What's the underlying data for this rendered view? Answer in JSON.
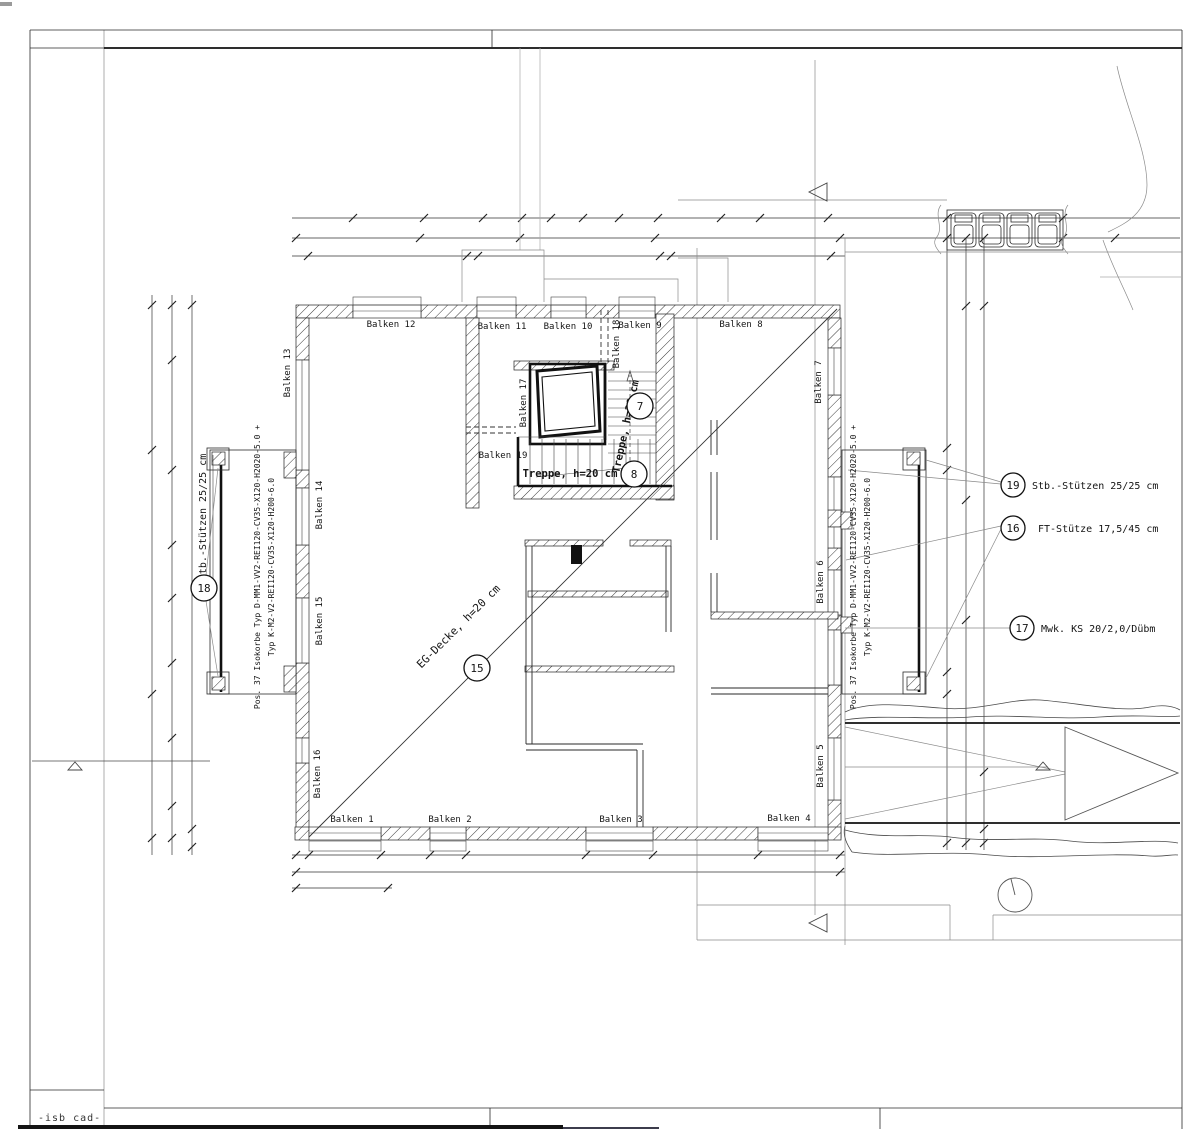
{
  "drawing": {
    "footer": "-isb cad-",
    "beams": [
      "Balken 1",
      "Balken 2",
      "Balken 3",
      "Balken 4",
      "Balken 5",
      "Balken 6",
      "Balken 7",
      "Balken 8",
      "Balken 9",
      "Balken 10",
      "Balken 11",
      "Balken 12",
      "Balken 13",
      "Balken 14",
      "Balken 15",
      "Balken 16",
      "Balken 17",
      "Balken 18",
      "Balken 19"
    ],
    "stairs": {
      "lower": "Treppe, h=20 cm",
      "upper": "Treppe, h=20 cm"
    },
    "deck_label": "EG-Decke, h=20 cm",
    "left_support_label": "Stb.-Stützen 25/25 cm",
    "isokorb": {
      "line1": "Pos. 37 Isokorbe Typ D-MM1-VV2-REI120-CV35-X120-H2020-5.0 +",
      "line2": "Typ K-M2-V2-REI120-CV35-X120-H200-6.0"
    },
    "callouts": {
      "n7": "7",
      "n8": "8",
      "n15": "15",
      "n16": "16",
      "n17": "17",
      "n18": "18",
      "n19": "19"
    },
    "annotations": {
      "a19": "Stb.-Stützen 25/25 cm",
      "a16": "FT-Stütze 17,5/45 cm",
      "a17": "Mwk. KS 20/2,0/Dübm"
    }
  }
}
